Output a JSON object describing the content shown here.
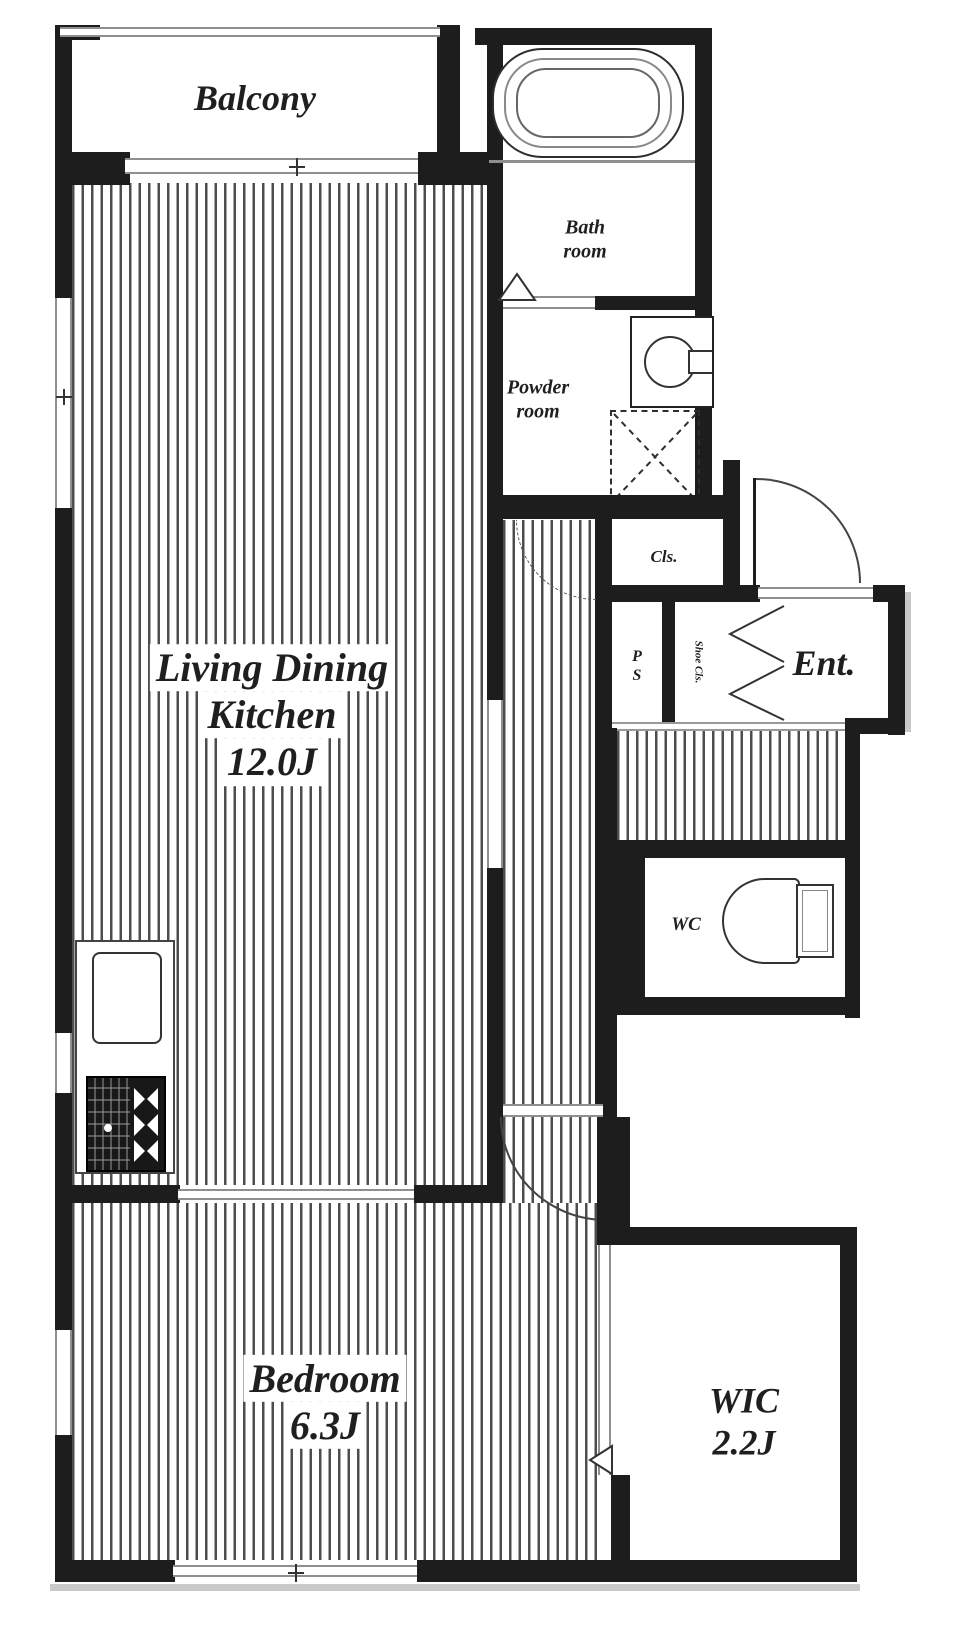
{
  "plan": {
    "rooms": {
      "balcony": {
        "label": "Balcony"
      },
      "bath": {
        "line1": "Bath",
        "line2": "room"
      },
      "powder": {
        "line1": "Powder",
        "line2": "room"
      },
      "ldk": {
        "line1": "Living Dining",
        "line2": "Kitchen",
        "size": "12.0J"
      },
      "closet": {
        "label": "Cls."
      },
      "pipe_space": {
        "line1": "P",
        "line2": "S"
      },
      "shoe_closet": {
        "label": "Shoe Cls."
      },
      "entrance": {
        "label": "Ent."
      },
      "wc": {
        "label": "WC"
      },
      "bedroom": {
        "label": "Bedroom",
        "size": "6.3J"
      },
      "wic": {
        "label": "WIC",
        "size": "2.2J"
      }
    },
    "colors": {
      "wall": "#1d1d1d",
      "window_frame": "#8f8f8f",
      "floor_stripe": "#4d4d4d",
      "fixture_line": "#333333"
    }
  }
}
